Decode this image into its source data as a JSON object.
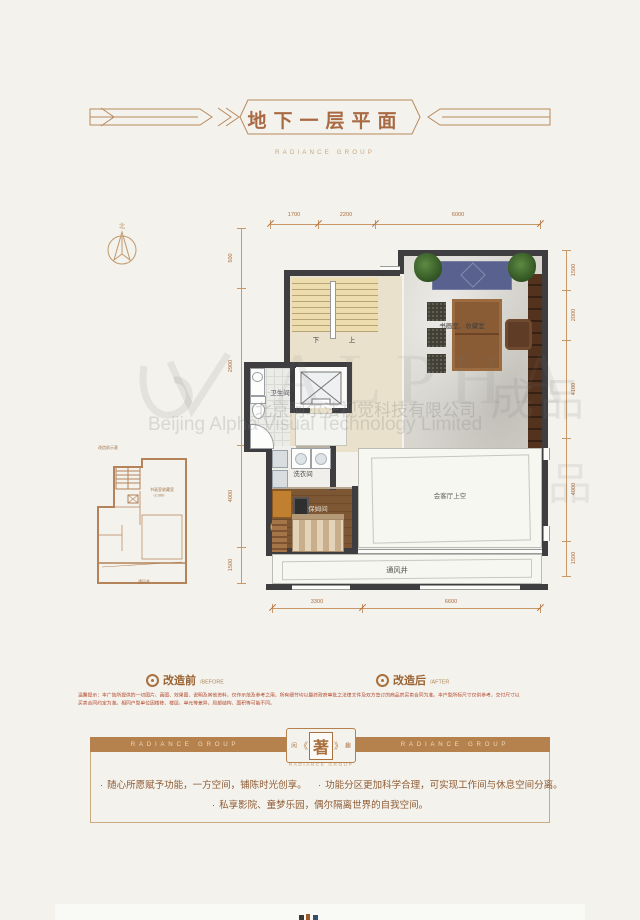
{
  "header": {
    "title": "地下一层平面",
    "subtitle": "RADIANCE GROUP"
  },
  "compass": {
    "north": "北"
  },
  "floorplan": {
    "dims": {
      "top": [
        "1700",
        "2200",
        "6000"
      ],
      "left": [
        "500",
        "2900",
        "4000",
        "1500"
      ],
      "right": [
        "1500",
        "2000",
        "4100",
        "4000",
        "1500"
      ],
      "bottom": [
        "3300",
        "6600"
      ]
    },
    "rooms": {
      "study": "书画室、收藏室",
      "bathroom": "卫生间",
      "laundry": "洗衣间",
      "maid": "保姆间",
      "void": "会客厅上空",
      "vent": "通风井",
      "stair_down": "下",
      "stair_up": "上"
    }
  },
  "inset": {
    "caption": "改造前示意",
    "room": "书画室收藏室",
    "level": "-2.000",
    "vent": "通风井"
  },
  "legend": {
    "before": "改造前",
    "before_en": "/BEFORE",
    "after": "改造后",
    "after_en": "/AFTER"
  },
  "disclaimer": {
    "line1": "温馨提示：本广告所提供的一切图片、画图、效果图、说明及其他资料，仅作示范及参考之用，所有细节均以最终政府审批之法律文件及双方签订的商品房买卖合同为准。本户型所标尺寸仅供参考，交付尺寸以",
    "line2": "买卖合同约定为准。相同户型单位因楼栋、楼层、单元等差异，局部结构、面积等可能不同。"
  },
  "banner": {
    "group": "RADIANCE GROUP",
    "seal_left": "闲",
    "seal": "著",
    "seal_right": "趣",
    "chevron_left": "《",
    "chevron_right": "》",
    "brand_sub": "RADIANCE GROUP"
  },
  "footer": {
    "dot": "·",
    "bullets": [
      "随心所愿赋予功能，一方空间，铺陈时光创享。",
      "功能分区更加科学合理，可实现工作间与休息空间分离。",
      "私享影院、童梦乐园，偶尔隔离世界的自我空间。"
    ]
  },
  "watermark": {
    "logo": "ALPHA",
    "company_cn": "北京阿尔法视觉科技有限公司",
    "company_en": "Beijing Alpha Visual Technology Limited",
    "stamp_a": "成品",
    "stamp_b": "品"
  },
  "colors": {
    "accent_brown": "#a9713f",
    "banner_bar": "#b5824d",
    "wall": "#3e3e40",
    "dimension": "#ad6e3f",
    "warning_red": "#b4492e",
    "page_bg": "#f3f2ec"
  }
}
